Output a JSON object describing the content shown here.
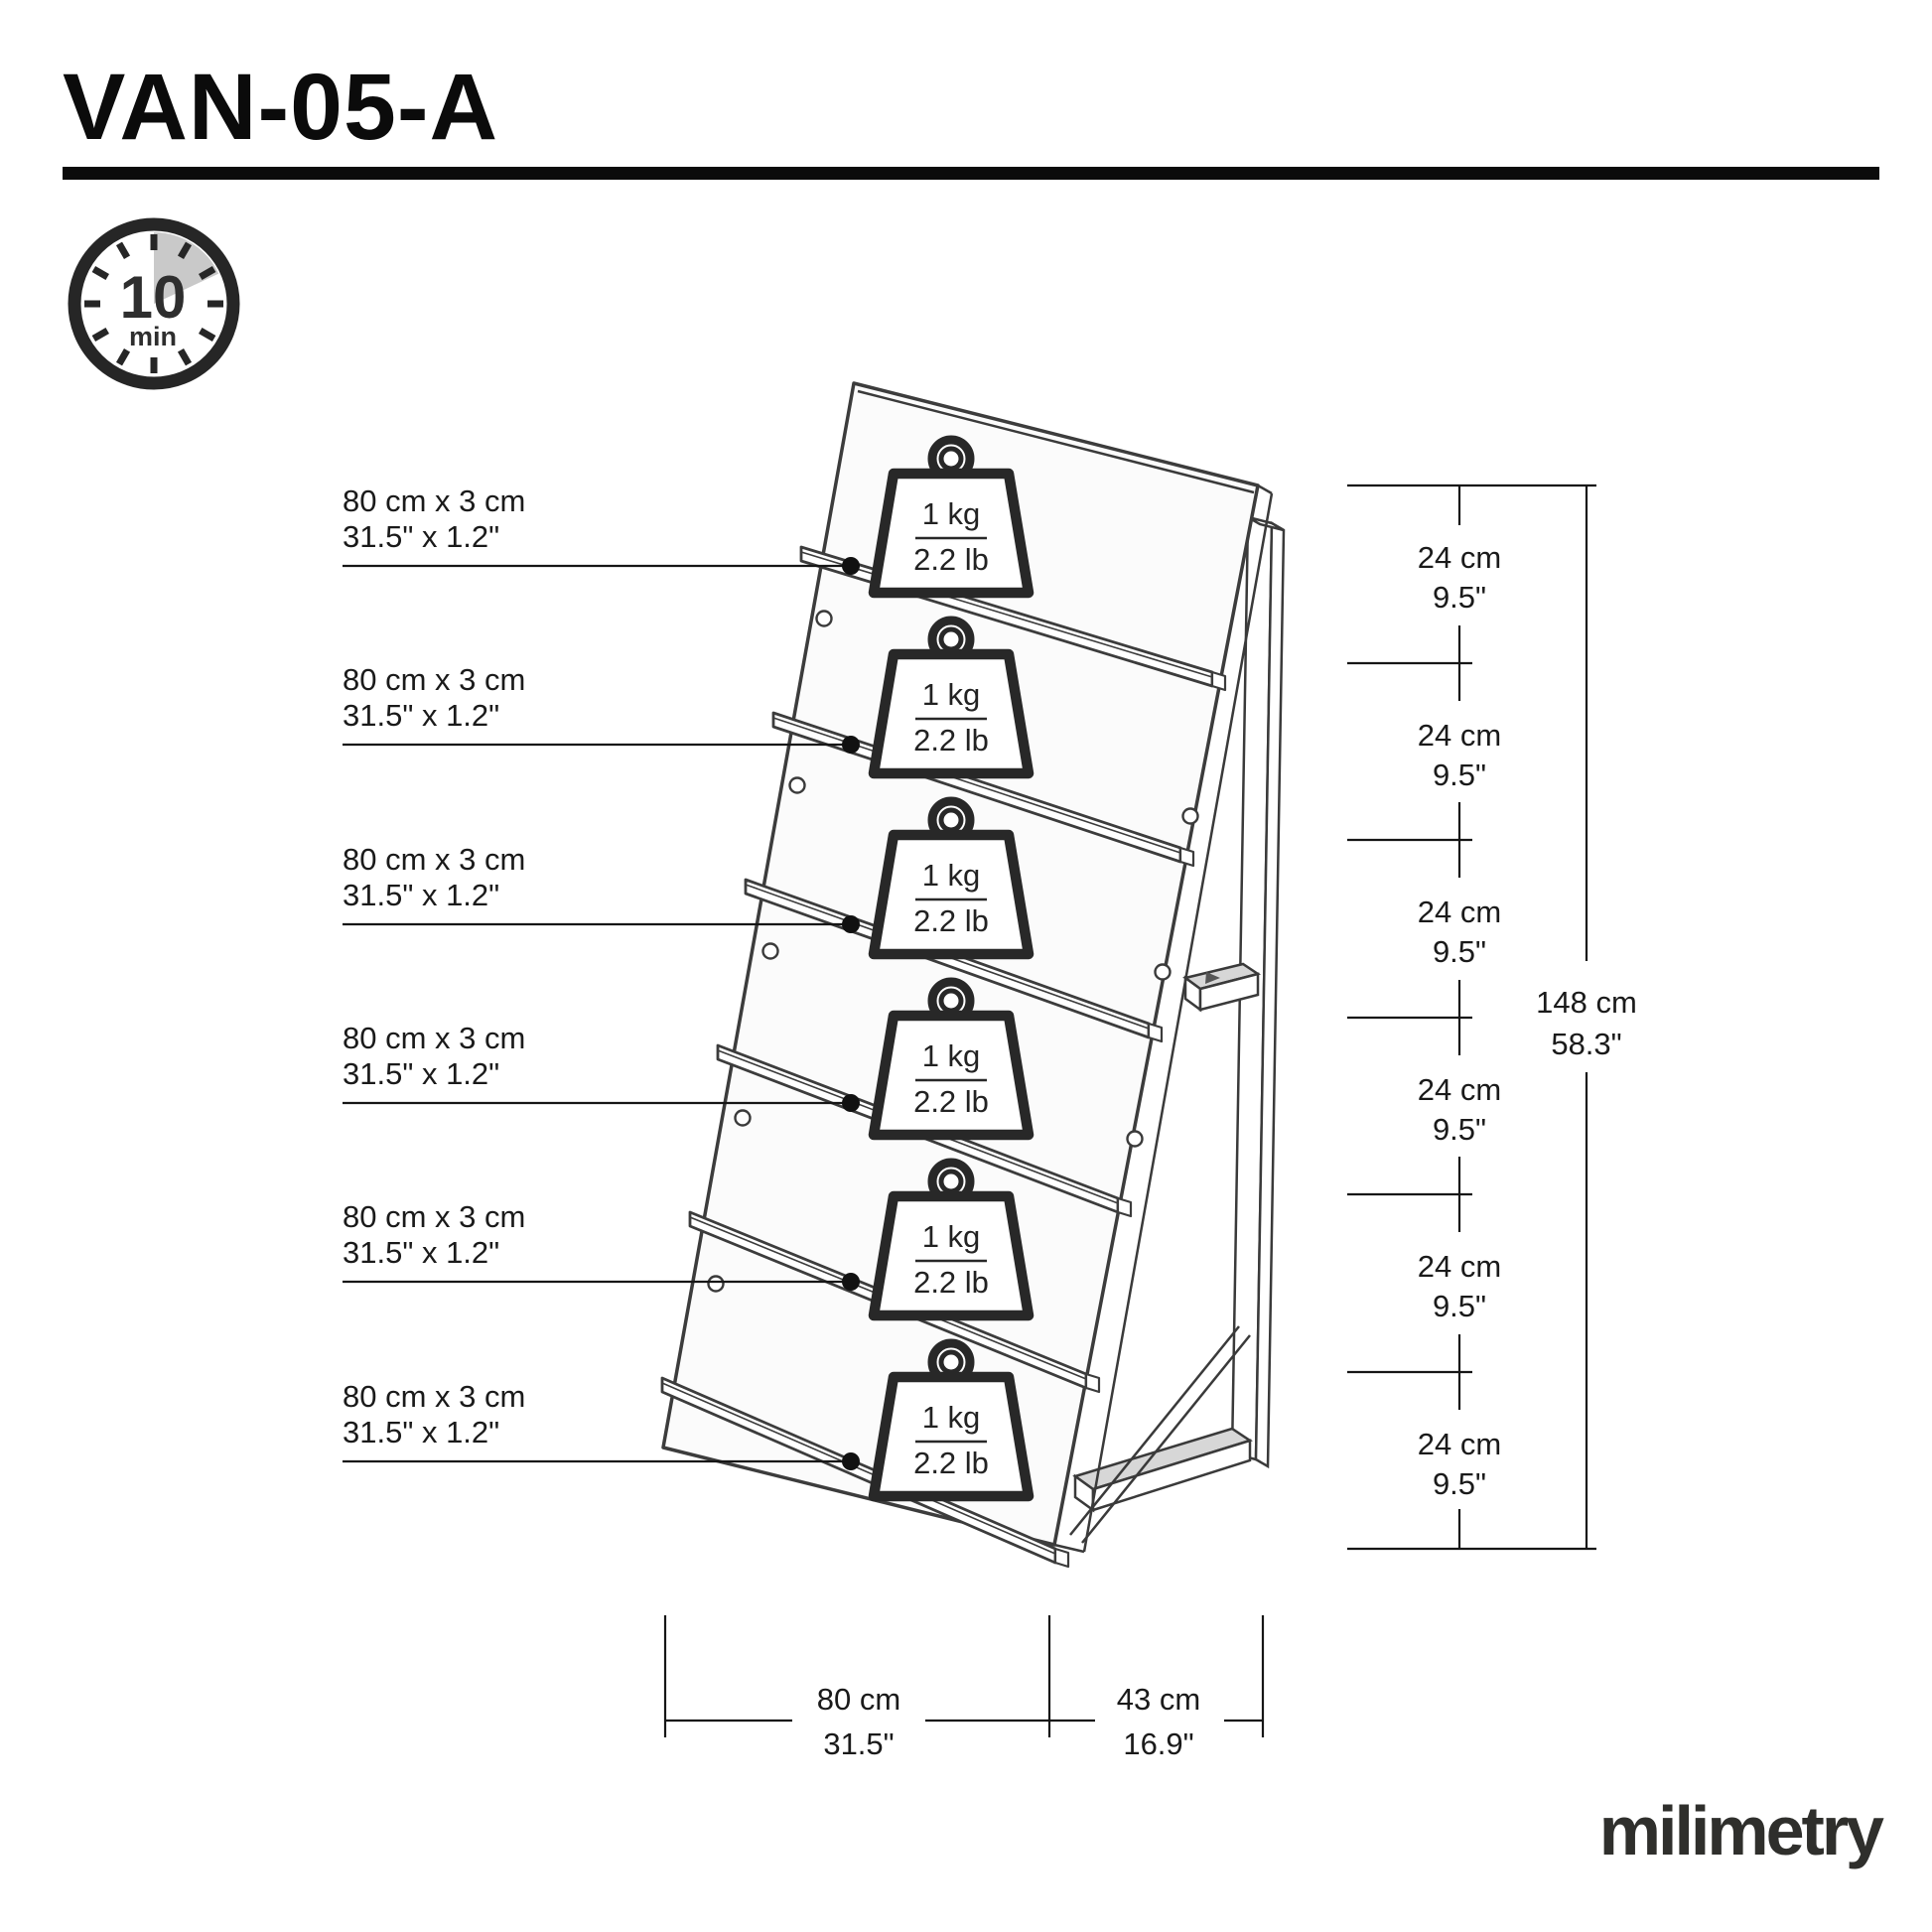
{
  "title": "VAN-05-A",
  "clock": {
    "value": "10",
    "unit": "min"
  },
  "shelf_labels": [
    {
      "size_metric": "80 cm x 3 cm",
      "size_imperial": "31.5\" x 1.2\""
    },
    {
      "size_metric": "80 cm x 3 cm",
      "size_imperial": "31.5\" x 1.2\""
    },
    {
      "size_metric": "80 cm x 3 cm",
      "size_imperial": "31.5\" x 1.2\""
    },
    {
      "size_metric": "80 cm x 3 cm",
      "size_imperial": "31.5\" x 1.2\""
    },
    {
      "size_metric": "80 cm x 3 cm",
      "size_imperial": "31.5\" x 1.2\""
    },
    {
      "size_metric": "80 cm x 3 cm",
      "size_imperial": "31.5\" x 1.2\""
    }
  ],
  "weights": [
    {
      "metric": "1 kg",
      "imperial": "2.2 lb"
    },
    {
      "metric": "1 kg",
      "imperial": "2.2 lb"
    },
    {
      "metric": "1 kg",
      "imperial": "2.2 lb"
    },
    {
      "metric": "1 kg",
      "imperial": "2.2 lb"
    },
    {
      "metric": "1 kg",
      "imperial": "2.2 lb"
    },
    {
      "metric": "1 kg",
      "imperial": "2.2 lb"
    }
  ],
  "right_dimensions": [
    {
      "metric": "24 cm",
      "imperial": "9.5\""
    },
    {
      "metric": "24 cm",
      "imperial": "9.5\""
    },
    {
      "metric": "24 cm",
      "imperial": "9.5\""
    },
    {
      "metric": "24 cm",
      "imperial": "9.5\""
    },
    {
      "metric": "24 cm",
      "imperial": "9.5\""
    },
    {
      "metric": "24 cm",
      "imperial": "9.5\""
    }
  ],
  "total_height": {
    "metric": "148 cm",
    "imperial": "58.3\""
  },
  "bottom_dimensions": [
    {
      "metric": "80 cm",
      "imperial": "31.5\""
    },
    {
      "metric": "43 cm",
      "imperial": "16.9\""
    }
  ],
  "logo": "milimetry"
}
